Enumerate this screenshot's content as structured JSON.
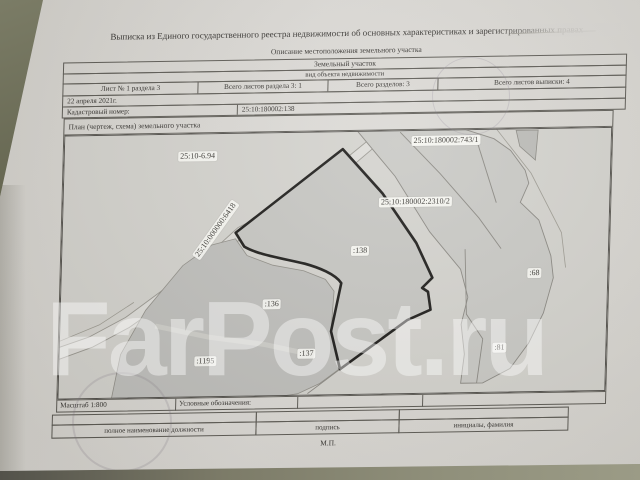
{
  "photo": {
    "watermark": "FarPost.ru"
  },
  "document": {
    "title": "Выписка из Единого государственного реестра недвижимости об основных характеристиках и зарегистрированных правах",
    "subtitle": "Описание местоположения земельного участка",
    "object_type": {
      "value": "Земельный участок",
      "caption": "вид объекта недвижимости"
    },
    "sheet_info": {
      "sheet": "Лист № 1 раздела 3",
      "sheets_in_section": "Всего листов раздела 3: 1",
      "sections_total": "Всего разделов: 3",
      "sheets_total": "Всего листов выписки: 4"
    },
    "date": "22 апреля 2021г.",
    "cadastral_number": {
      "label": "Кадастровый номер:",
      "value": "25:10:180002:138"
    },
    "plan": {
      "title": "План (чертеж, схема) земельного участка",
      "scale": "Масштаб 1:800",
      "legend_label": "Условные обозначения:"
    },
    "signature_block": {
      "position_label": "полное наименование должности",
      "signature_label": "подпись",
      "name_label": "инициалы, фамилия",
      "seal_label": "М.П."
    }
  },
  "map": {
    "labels": [
      {
        "text": "25:10-6.94"
      },
      {
        "text": "25:10:000000:6418"
      },
      {
        "text": "25:10:180002:743/1"
      },
      {
        "text": "25:10:180002:2310/2"
      },
      {
        "text": ":138"
      },
      {
        "text": ":136"
      },
      {
        "text": ":137"
      },
      {
        "text": ":1195"
      },
      {
        "text": ":68"
      },
      {
        "text": ":81"
      }
    ],
    "highlight_parcel": ":138",
    "colors": {
      "parcel_fill": "#c4c4c0",
      "highlight_outline": "#151412",
      "road_fill": "#dcdbd7"
    }
  }
}
